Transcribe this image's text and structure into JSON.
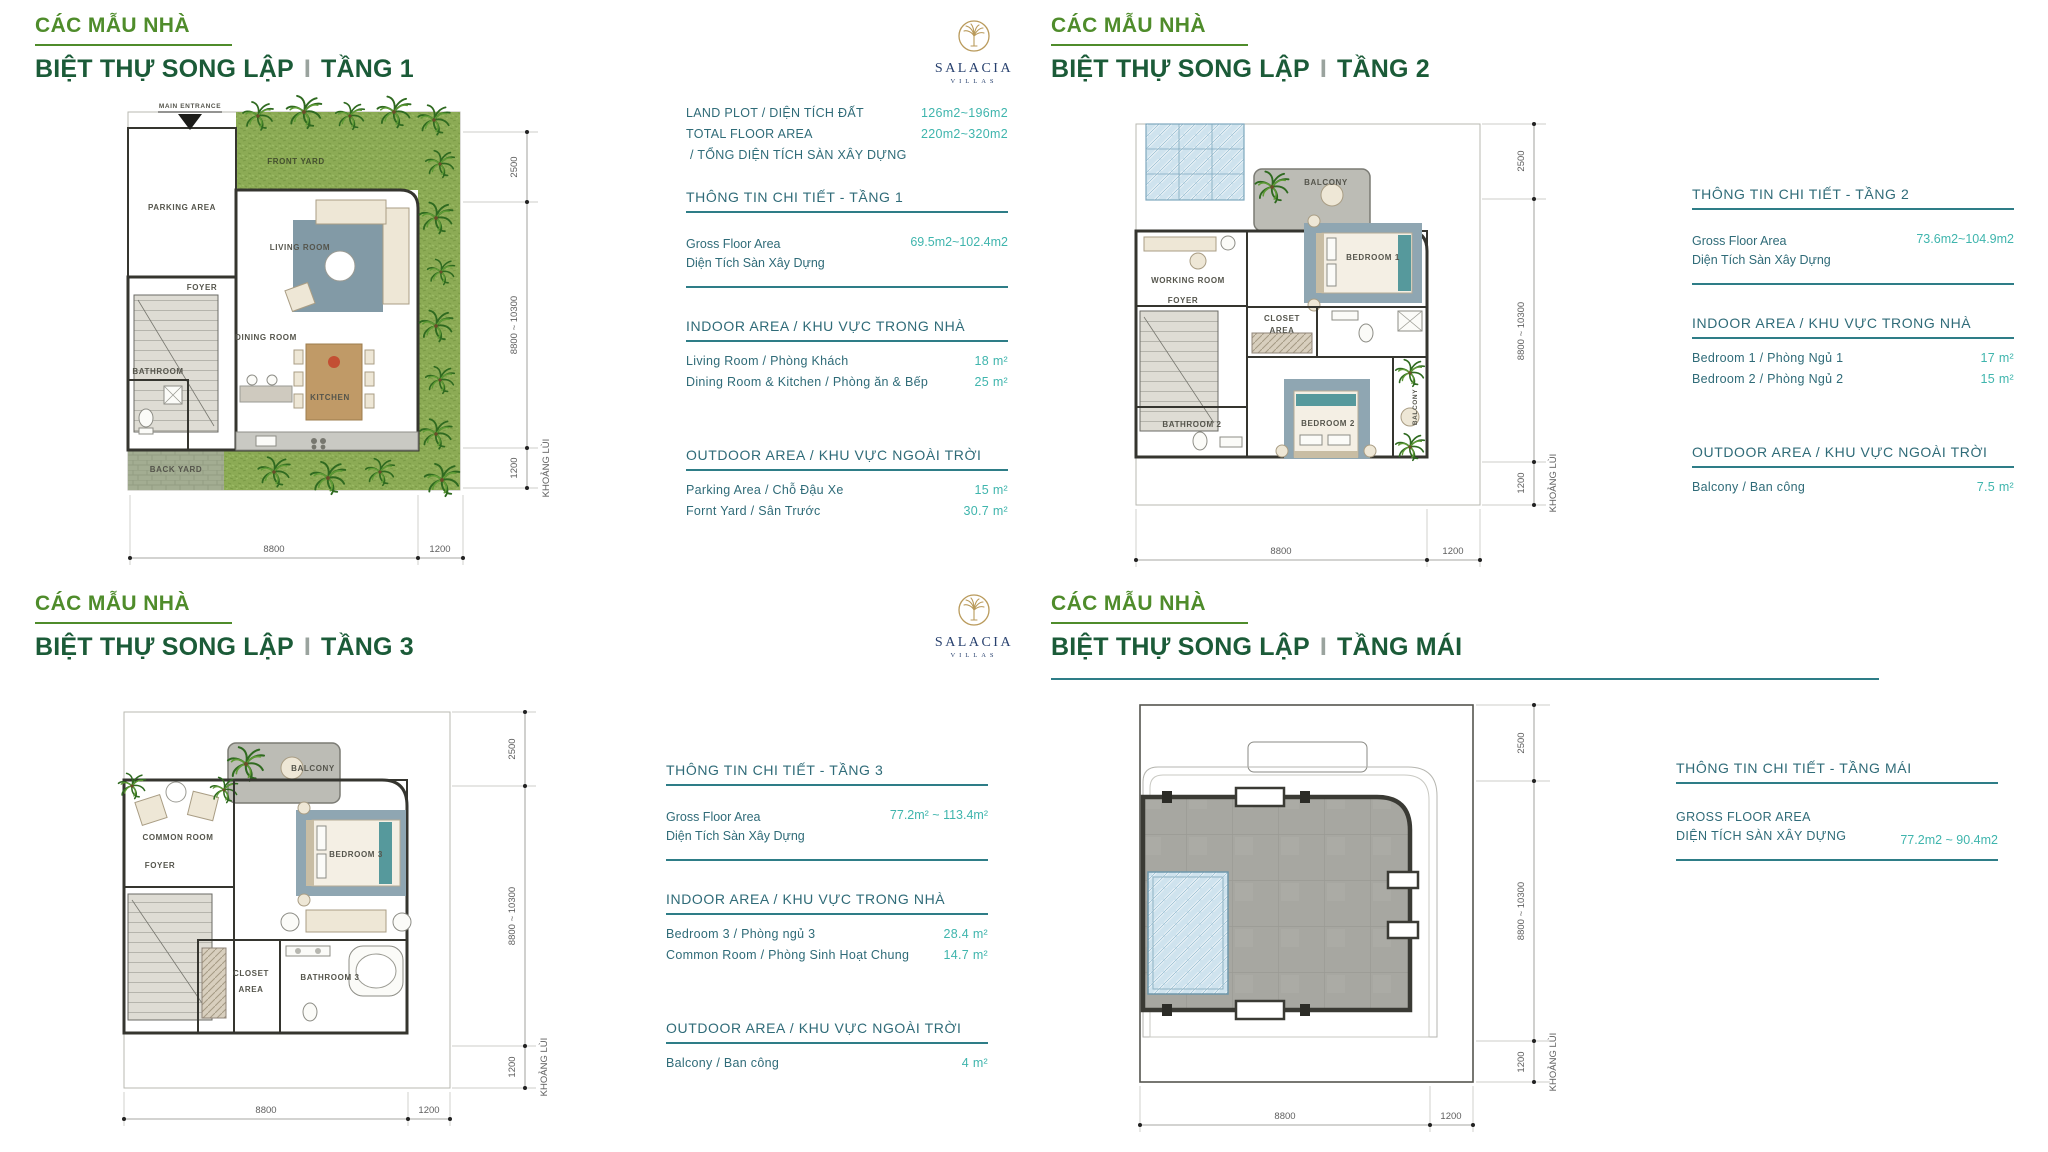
{
  "brand": {
    "name": "SALACIA",
    "sub": "VILLAS"
  },
  "shared": {
    "kicker": "CÁC MẪU NHÀ",
    "series": "BIỆT THỰ SONG LẬP",
    "separator": "I"
  },
  "dims": {
    "right": [
      "2500",
      "8800 ~ 10300",
      "1200"
    ],
    "right_note": "KHOẢNG LÙI",
    "bottom": [
      "8800",
      "1200"
    ]
  },
  "floor1": {
    "floor": "TẦNG 1",
    "summary": [
      {
        "label": "LAND PLOT / DIỆN TÍCH ĐẤT",
        "value": "126m2~196m2"
      },
      {
        "label": "TOTAL FLOOR AREA",
        "value": "220m2~320m2"
      },
      {
        "label": "/ TỔNG DIỆN TÍCH SÀN XÂY DỰNG",
        "value": ""
      }
    ],
    "detail_title": "THÔNG TIN CHI TIẾT - TẦNG 1",
    "gfa": {
      "label_en": "Gross Floor Area",
      "label_vi": "Diện Tích Sàn Xây Dựng",
      "value": "69.5m2~102.4m2"
    },
    "indoor": {
      "title": "INDOOR AREA / KHU VỰC TRONG NHÀ",
      "rows": [
        {
          "label": "Living Room / Phòng Khách",
          "value": "18 m²"
        },
        {
          "label": "Dining Room & Kitchen / Phòng ăn & Bếp",
          "value": "25 m²"
        }
      ]
    },
    "outdoor": {
      "title": "OUTDOOR AREA / KHU VỰC NGOÀI TRỜI",
      "rows": [
        {
          "label": "Parking Area / Chỗ Đậu Xe",
          "value": "15 m²"
        },
        {
          "label": "Fornt Yard / Sân Trước",
          "value": "30.7 m²"
        }
      ]
    },
    "rooms": {
      "main_entrance": "MAIN ENTRANCE",
      "parking": "PARKING AREA",
      "front_yard": "FRONT YARD",
      "living": "LIVING ROOM",
      "foyer": "FOYER",
      "dining": "DINING ROOM",
      "kitchen": "KITCHEN",
      "bathroom": "BATHROOM",
      "back_yard": "BACK YARD"
    }
  },
  "floor2": {
    "floor": "TẦNG 2",
    "detail_title": "THÔNG TIN CHI TIẾT - TẦNG 2",
    "gfa": {
      "label_en": "Gross Floor Area",
      "label_vi": "Diện Tích Sàn Xây Dựng",
      "value": "73.6m2~104.9m2"
    },
    "indoor": {
      "title": "INDOOR AREA / KHU VỰC TRONG NHÀ",
      "rows": [
        {
          "label": "Bedroom 1 / Phòng Ngủ 1",
          "value": "17 m²"
        },
        {
          "label": "Bedroom 2 / Phòng Ngủ 2",
          "value": "15 m²"
        }
      ]
    },
    "outdoor": {
      "title": "OUTDOOR AREA / KHU VỰC NGOÀI TRỜI",
      "rows": [
        {
          "label": "Balcony / Ban công",
          "value": "7.5 m²"
        }
      ]
    },
    "rooms": {
      "balcony": "BALCONY",
      "working": "WORKING ROOM",
      "foyer": "FOYER",
      "bedroom1": "BEDROOM 1",
      "closet1": "CLOSET",
      "closet2": "AREA",
      "bathroom2": "BATHROOM 2",
      "bedroom2": "BEDROOM 2",
      "balcony_side": "BALCONY"
    }
  },
  "floor3": {
    "floor": "TẦNG 3",
    "detail_title": "THÔNG TIN CHI TIẾT - TẦNG 3",
    "gfa": {
      "label_en": "Gross Floor Area",
      "label_vi": "Diện Tích Sàn Xây Dựng",
      "value": "77.2m² ~ 113.4m²"
    },
    "indoor": {
      "title": "INDOOR AREA / KHU VỰC TRONG NHÀ",
      "rows": [
        {
          "label": "Bedroom 3 / Phòng ngủ 3",
          "value": "28.4 m²"
        },
        {
          "label": "Common Room / Phòng Sinh Hoạt Chung",
          "value": "14.7 m²"
        }
      ]
    },
    "outdoor": {
      "title": "OUTDOOR AREA / KHU VỰC NGOÀI TRỜI",
      "rows": [
        {
          "label": "Balcony / Ban công",
          "value": "4 m²"
        }
      ]
    },
    "rooms": {
      "balcony": "BALCONY",
      "common": "COMMON ROOM",
      "foyer": "FOYER",
      "bedroom3": "BEDROOM 3",
      "closet1": "CLOSET",
      "closet2": "AREA",
      "bathroom3": "BATHROOM 3"
    }
  },
  "floor4": {
    "floor": "TẦNG MÁI",
    "detail_title": "THÔNG TIN CHI TIẾT - TẦNG MÁI",
    "gfa": {
      "label_en": "GROSS FLOOR AREA",
      "label_vi": "DIỆN TÍCH SÀN XÂY DỰNG",
      "value": "77.2m2 ~ 90.4m2"
    }
  }
}
